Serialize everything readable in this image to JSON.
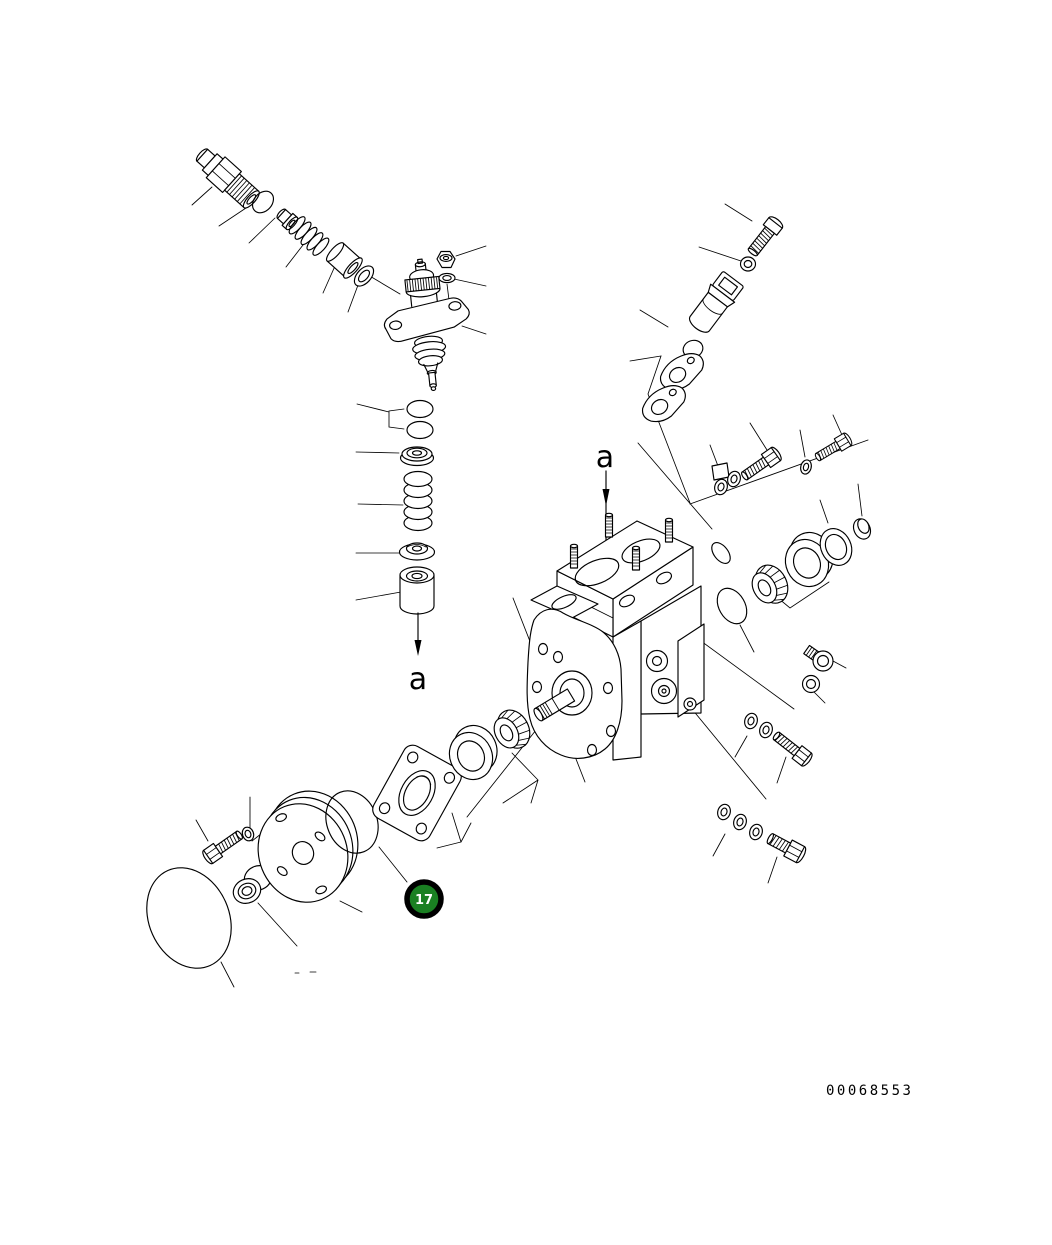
{
  "page": {
    "background_color": "#ffffff",
    "line_color": "#000000"
  },
  "diagram": {
    "type": "exploded-parts-diagram",
    "view_labels": {
      "top": "a",
      "bottom": "a"
    },
    "callout": {
      "number": "17",
      "fill_color": "#1a8022",
      "ring_color": "#000000",
      "text_color": "#ffffff"
    },
    "figure_number": "00068553"
  }
}
